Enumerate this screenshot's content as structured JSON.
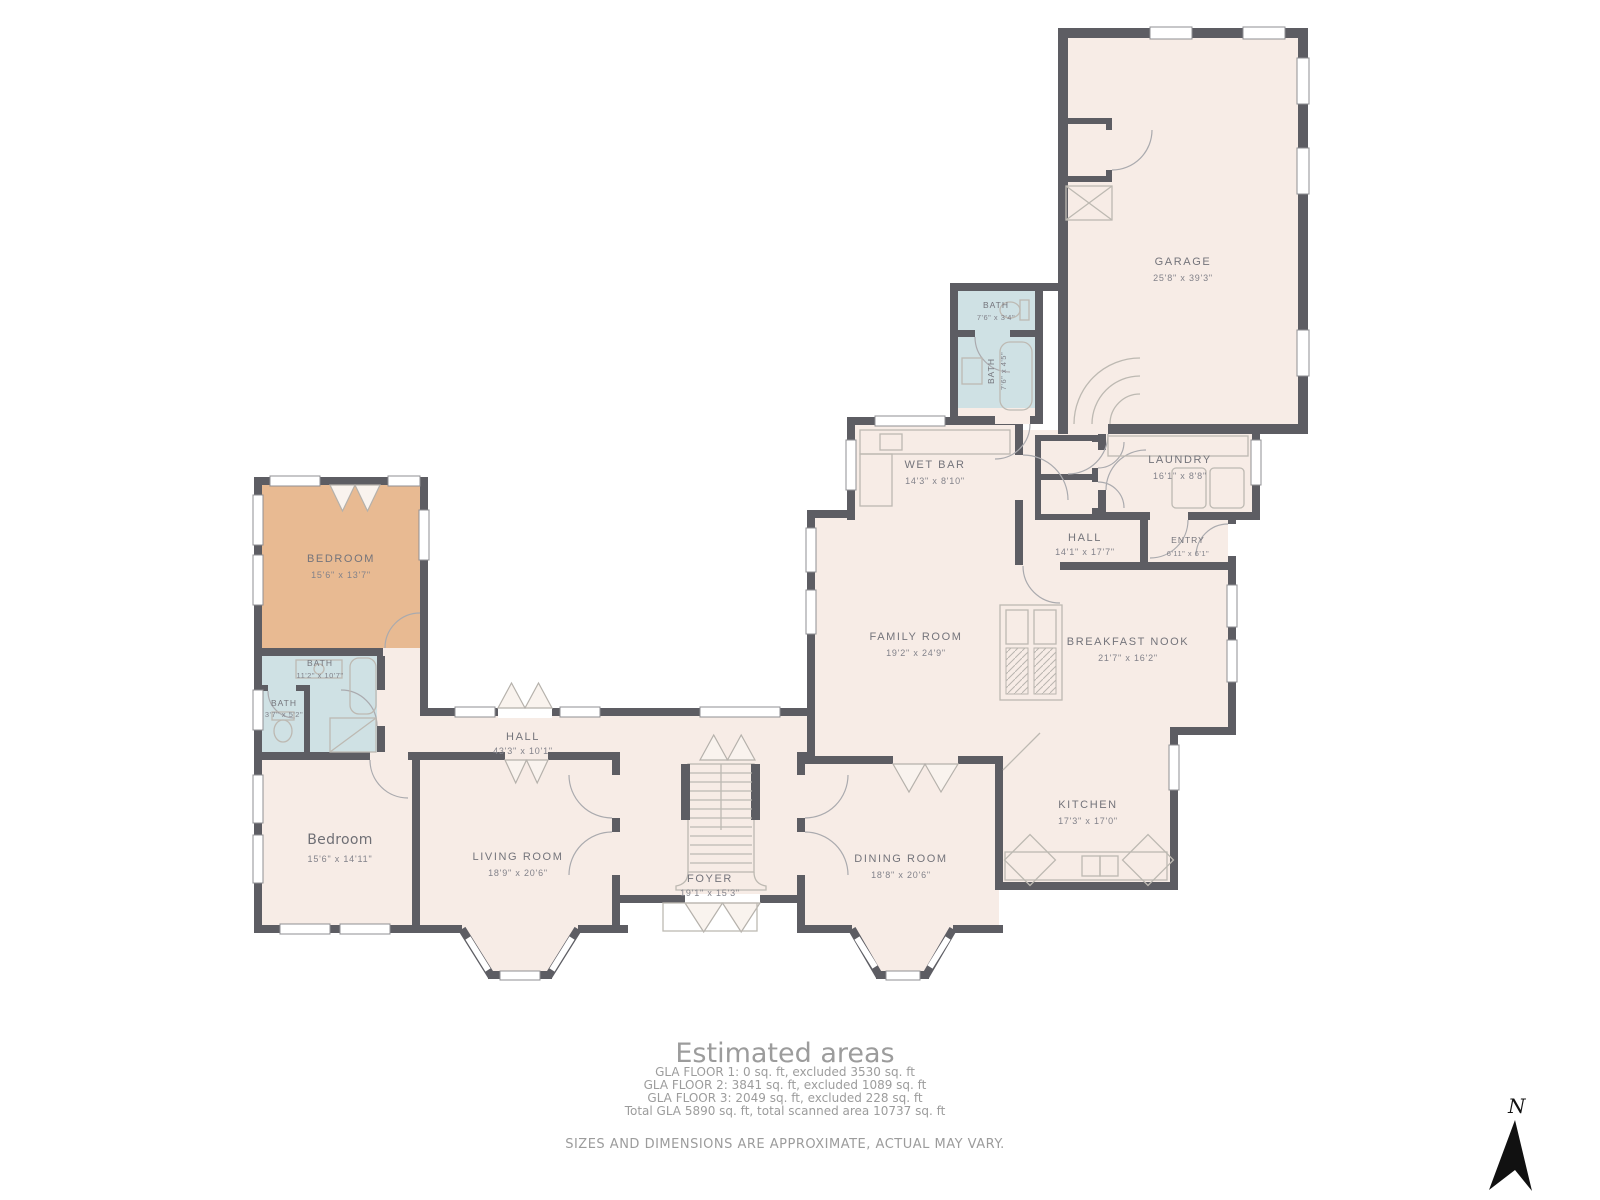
{
  "colors": {
    "wall": "#5d5d63",
    "floor": "#f7ece6",
    "bath_floor": "#cfe1e4",
    "accent_bedroom_floor": "#e8ba92",
    "room_label": "#74747b",
    "footer_text": "#9c9c9c",
    "background": "#ffffff"
  },
  "rooms": [
    {
      "name": "GARAGE",
      "dims": "25'8\" x 39'3\""
    },
    {
      "name": "BATH",
      "dims": "7'6\" x 3'4\""
    },
    {
      "name": "BATH",
      "dims": "7'6\" x 4'5\""
    },
    {
      "name": "WET BAR",
      "dims": "14'3\" x 8'10\""
    },
    {
      "name": "LAUNDRY",
      "dims": "16'1\" x 8'8\""
    },
    {
      "name": "HALL",
      "dims": "14'1\" x 17'7\""
    },
    {
      "name": "ENTRY",
      "dims": "6'11\" x 6'1\""
    },
    {
      "name": "FAMILY ROOM",
      "dims": "19'2\" x 24'9\""
    },
    {
      "name": "BREAKFAST NOOK",
      "dims": "21'7\" x 16'2\""
    },
    {
      "name": "BEDROOM",
      "dims": "15'6\" x 13'7\""
    },
    {
      "name": "BATH",
      "dims": "11'2\" x 10'7\""
    },
    {
      "name": "BATH",
      "dims": "3'7\" x 5'2\""
    },
    {
      "name": "HALL",
      "dims": "43'3\" x 10'1\""
    },
    {
      "name": "Bedroom",
      "dims": "15'6\" x 14'11\""
    },
    {
      "name": "LIVING ROOM",
      "dims": "18'9\" x 20'6\""
    },
    {
      "name": "FOYER",
      "dims": "19'1\" x 15'3\""
    },
    {
      "name": "DINING ROOM",
      "dims": "18'8\" x 20'6\""
    },
    {
      "name": "KITCHEN",
      "dims": "17'3\" x 17'0\""
    }
  ],
  "footer": {
    "title": "Estimated areas",
    "lines": [
      "GLA FLOOR 1: 0 sq. ft, excluded 3530 sq. ft",
      "GLA FLOOR 2: 3841 sq. ft, excluded 1089 sq. ft",
      "GLA FLOOR 3: 2049 sq. ft, excluded 228 sq. ft",
      "Total GLA 5890 sq. ft, total scanned area 10737 sq. ft"
    ],
    "disclaimer": "SIZES AND DIMENSIONS ARE APPROXIMATE, ACTUAL MAY VARY."
  },
  "compass": {
    "label": "N"
  }
}
